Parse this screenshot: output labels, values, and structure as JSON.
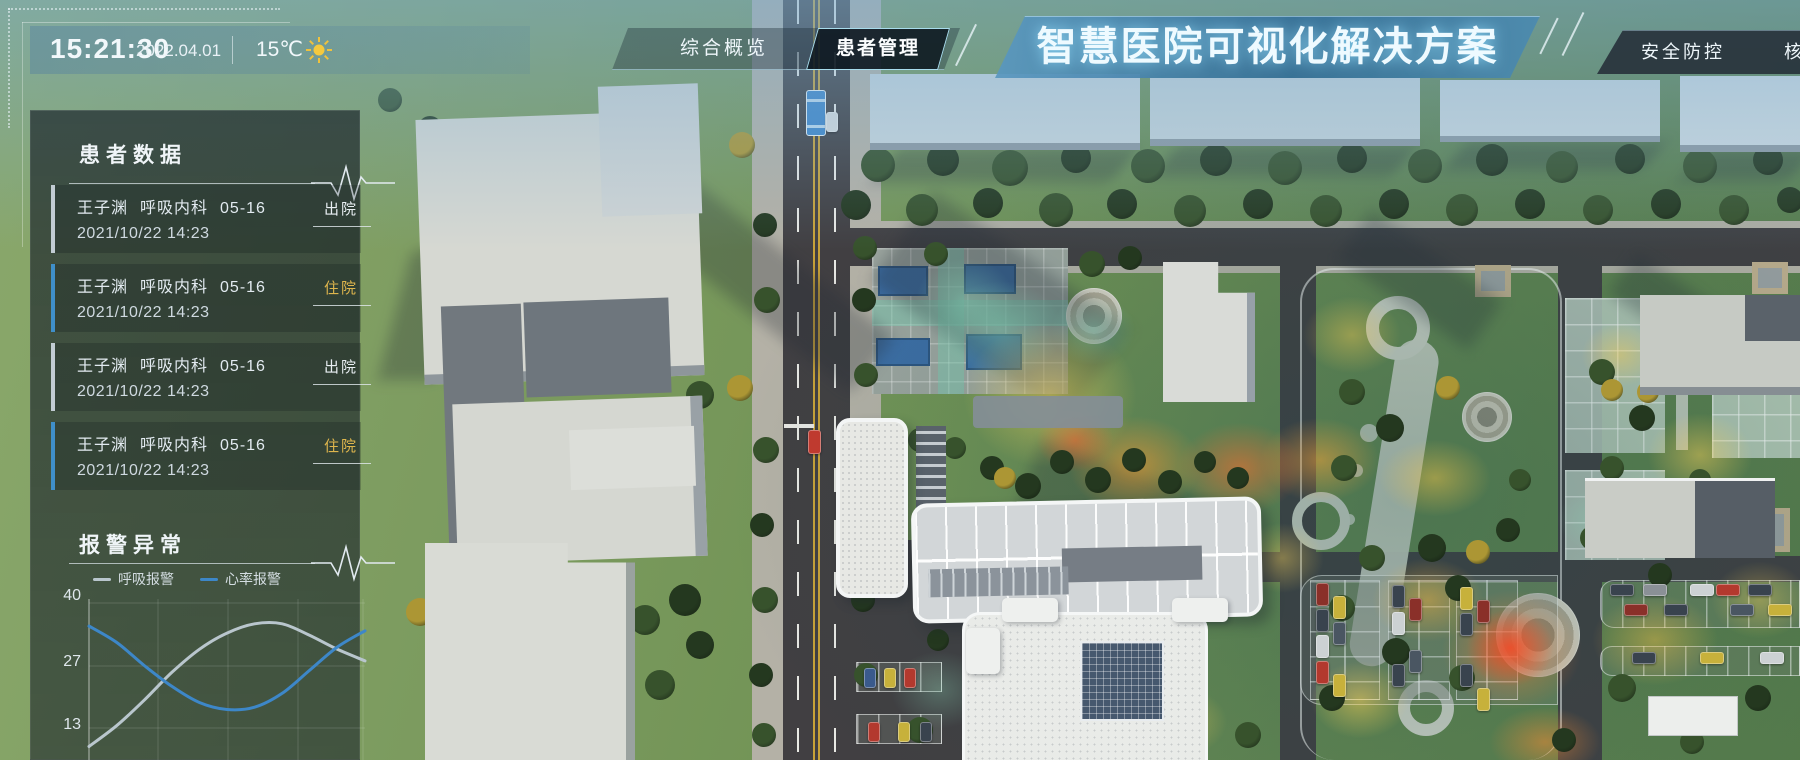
{
  "header": {
    "time": "15:21:30",
    "date": "2022.04.01",
    "temperature": "15℃",
    "weather_icon": "sun-icon",
    "title": "智慧医院可视化解决方案",
    "tabs": [
      {
        "label": "综合概览",
        "active": false
      },
      {
        "label": "患者管理",
        "active": true
      },
      {
        "label": "安全防控",
        "active": false
      },
      {
        "label": "核",
        "active": false
      }
    ]
  },
  "patient_panel": {
    "title": "患者数据",
    "header_icon": "pulse-icon",
    "entries": [
      {
        "name": "王子渊",
        "department": "呼吸内科",
        "bed": "05-16",
        "datetime": "2021/10/22 14:23",
        "status": "出院",
        "accent": "#c2ccd3"
      },
      {
        "name": "王子渊",
        "department": "呼吸内科",
        "bed": "05-16",
        "datetime": "2021/10/22 14:23",
        "status": "住院",
        "accent": "#3f8fc9"
      },
      {
        "name": "王子渊",
        "department": "呼吸内科",
        "bed": "05-16",
        "datetime": "2021/10/22 14:23",
        "status": "出院",
        "accent": "#c2ccd3"
      },
      {
        "name": "王子渊",
        "department": "呼吸内科",
        "bed": "05-16",
        "datetime": "2021/10/22 14:23",
        "status": "住院",
        "accent": "#3f8fc9"
      }
    ],
    "status_colors": {
      "出院": "#e8eef2",
      "住院": "#ddb54d"
    }
  },
  "alarm_panel": {
    "title": "报警异常",
    "header_icon": "pulse-icon",
    "legend": [
      {
        "label": "呼吸报警",
        "color": "#b9c6cd"
      },
      {
        "label": "心率报警",
        "color": "#3d87c8"
      }
    ],
    "yticks": [
      "40",
      "27",
      "13"
    ]
  },
  "chart_data": {
    "type": "line",
    "title": "报警异常",
    "x": [
      0,
      1,
      2,
      3,
      4,
      5,
      6,
      7,
      8,
      9,
      10
    ],
    "series": [
      {
        "name": "呼吸报警",
        "color": "#b9c6cd",
        "values": [
          9,
          13.5,
          19,
          25,
          30,
          33.5,
          35.5,
          35.5,
          33,
          30,
          27.5
        ]
      },
      {
        "name": "心率报警",
        "color": "#3d87c8",
        "values": [
          35,
          31.5,
          26.5,
          22,
          18.5,
          17,
          17.5,
          20.5,
          25.5,
          30.5,
          34
        ]
      }
    ],
    "yticks": [
      40,
      27,
      13
    ],
    "ylim": [
      0,
      44
    ],
    "grid": true,
    "legend_position": "top",
    "xlabel": "",
    "ylabel": ""
  }
}
